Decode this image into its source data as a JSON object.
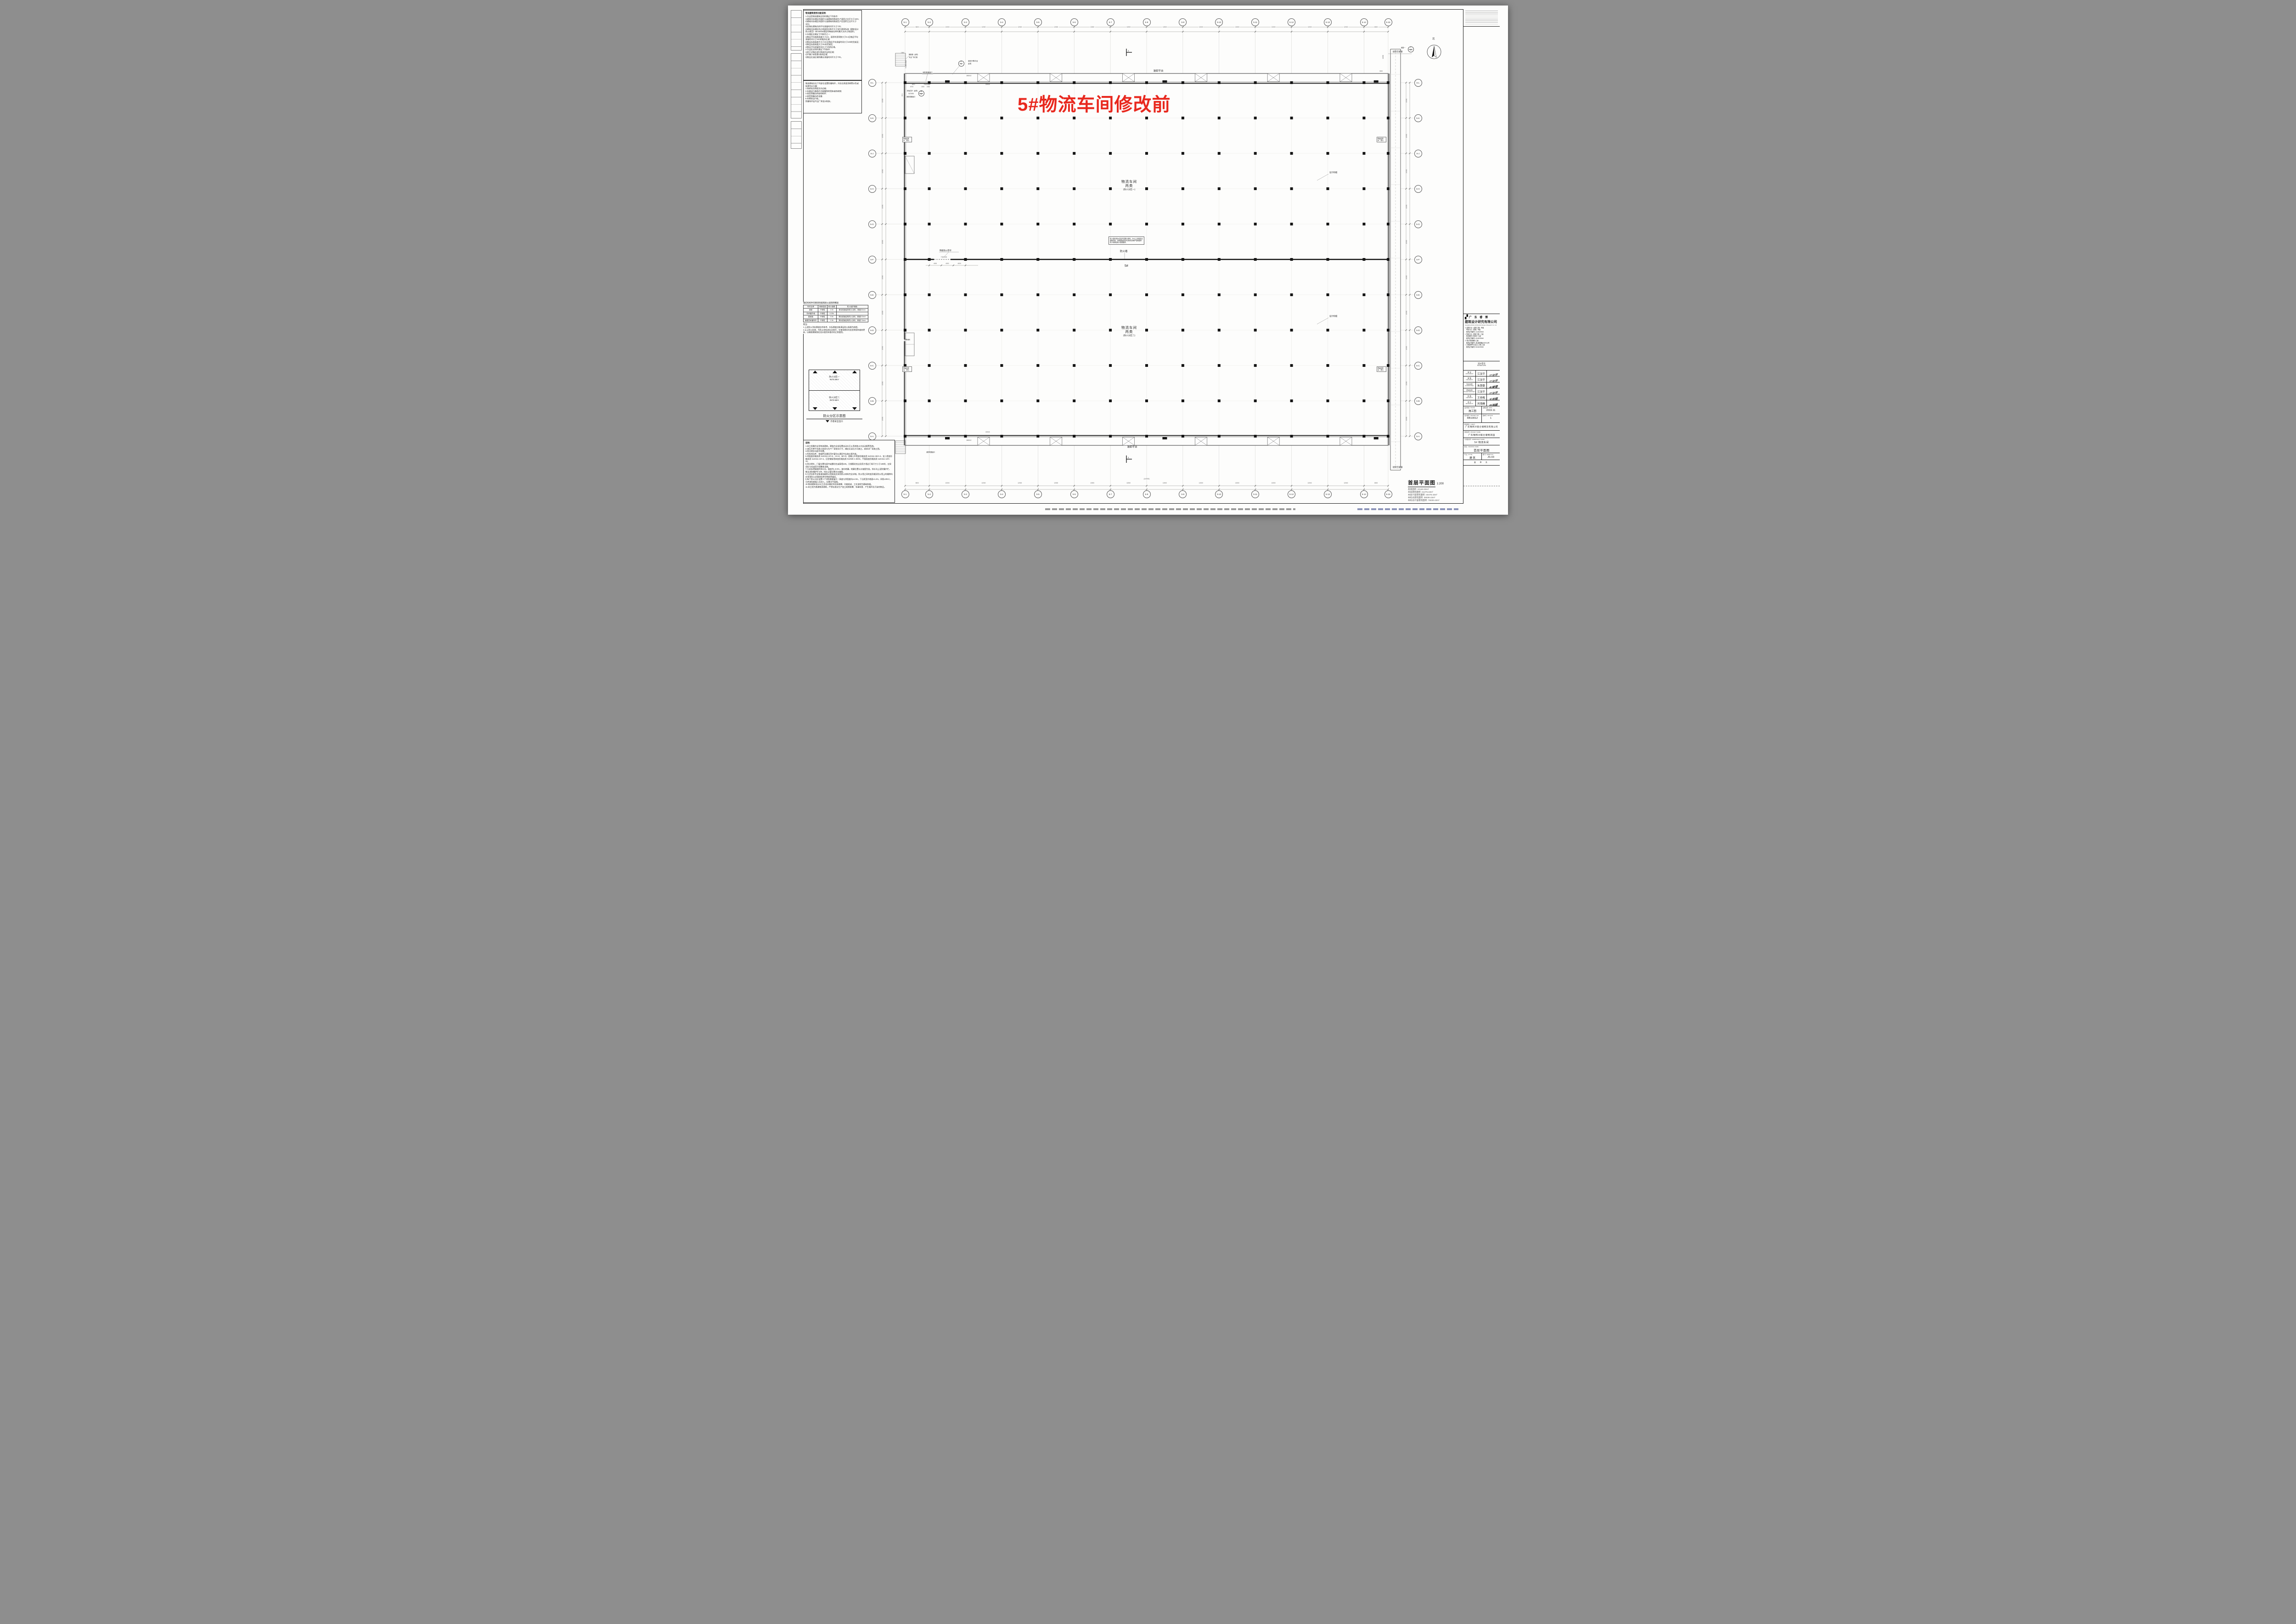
{
  "overlay": {
    "text": "5#物流车间修改前",
    "color": "#e8281e"
  },
  "notes_usage": {
    "title": "物流建筑使用功能说明:",
    "lines": [
      "1.作业型物流建筑应同时满足下列条件:",
      "1)建筑内存储区的面积与该建筑的物流生产面积之比不大于15%;",
      "2)建筑内存储区的容积与该建筑的物流生产区容积之比不大于15%;",
      "3)货物在建筑内的平均滞留时间不大于72h;",
      "4)建筑内存储区的占地面积总和不大于现行国家标准《建筑设计防火规范》GB 50016规定的每座仓库的最大允许占地面积。",
      "2.存储区应满足下列条件之一:",
      "1)物品平均堆放高度大于1m、面积利用系数大于0.4且物品平均滞留时间大于24h的堆存区域;",
      "2)物品存放高度不大于2m且物品平均滞留时间大于24h的货架区;",
      "3)物品存放高度大于2m的货架区;",
      "4)物品平均滞留时间大于72h的区域。",
      "3.作业区应同时满足下列条件:",
      "1)用于对物品进行物流作业的区域;",
      "2)不属于本条第1款的区域;",
      "3)物品在该区域的最长滞留时间不大于72h。"
    ]
  },
  "notes_collision": {
    "lines": [
      "物流建筑应在下列部位设置防撞构件，并应在表面涂刷警示色或贴黄色反光膜:",
      "1.装卸站台侧面及外边缘;",
      "2.车辆运行路线内可碰撞到的墙体或构筑物;",
      "3.易受到撞击的结构构件;",
      "4.易受到撞击的设备;",
      "5.车辆进出口处。",
      "防撞构件由专业厂商设计制安。"
    ]
  },
  "fire_table": {
    "title": "钢结构构件的燃烧性能和耐火极限明细表",
    "headers": [
      "构件名称",
      "燃烧性能",
      "耐火极限",
      "防火保护措施"
    ],
    "rows": [
      [
        "钢梁",
        "不燃性",
        "2.0h",
        "厚涂型钢结构防火涂料，厚度30mm"
      ],
      [
        "非承重外墙",
        "不燃性",
        "0.25h",
        ""
      ],
      [
        "屋面板",
        "不燃性",
        "0.5h",
        "薄涂型钢结构防火涂料，厚度3.0mm"
      ],
      [
        "钢屋顶承重构件",
        "不燃性",
        "1.5h",
        "薄涂型钢结构防火涂料，厚度7.0mm"
      ]
    ],
    "notes_title": "附注:",
    "notes": [
      "1.上述防火涂料厚度仅供参考，实际厚度应能满足耐火极限为前提。",
      "2.以上防火处理，为防止材料老化及损坏，在使用期间内应经常保持维修更新，以确保建筑物在设计使用年限内的正常使用。"
    ]
  },
  "fire_zone_diagram": {
    "title": "防火分区示意图",
    "legend": "示意安全出口",
    "zones": [
      {
        "name": "防火分区一",
        "area": "9575.58m²"
      },
      {
        "name": "防火分区二",
        "area": "9575.58m²"
      }
    ]
  },
  "general_notes": {
    "title": "说明:",
    "lines": [
      "1.本工程属作业型物流建筑。建筑内全部设置自动水灭火系统和火灾自动报警系统。",
      "2.液压升降平台施工前须与生产厂家核实尺寸，确定无误后方可施工，具体详厂家施工图。",
      "3.除注明外均居中布置。",
      "4.所有排风井、排烟井及通风百叶窗均以通风专业施工图为准。",
      "5.地面变形缝选用 11ZJ111 2/A-8、A/A-8、B/A-8，混凝土外墙变形缝选用 11ZJ111 26/A-2，女儿墙变形缝选用 11ZJ111 4/A-4，压型钢板墙体变形缝选用 01J925-1 48/44，平屋面变形缝选用 11ZJ111 12/A-12。",
      "6.除注明外，门窗位置均居中或靠砼柱或离墙100。凡钢筋砼柱边及剪力墙边门垛尺寸小于100时，应采用砼与柱或剪力墙整体浇筑。",
      "7.凡未标明坡度的排水沟，坡度为i=0.5%，坡向地漏，地漏位置以水施图为准。排水沟上设防撞护栏，做法详防撞护栏 8/9，排水立管位置详水施图。",
      "8.凡涉及各专业管道穿越防火墙体处应采用防火材料完全封堵。防火墙之间的变形缝及防火墙上的缝隙均应采用防火封堵材料将空隙紧密填实。",
      "9.每个防火分区设置二个消防救援窗口（高度与净宽度均≥1.0m，下沿距室内地面≤1.2m，间距≤20m），可供消防救援人员进入，位置详平面图。",
      "10.物流建筑设计以工艺设计确定的总体规模、功能组成、工艺流程为基础依据。",
      "11.本工程为普通物流建筑，严禁存放及生产加工易燃易爆、有毒有害、产生噪声及污染的物品。"
    ]
  },
  "plan": {
    "grid_top": {
      "labels": [
        "5-1",
        "5-2",
        "5-3",
        "5-4",
        "5-5",
        "5-6",
        "5-7",
        "5-8",
        "5-9",
        "5-10",
        "5-11",
        "5-12",
        "5-13",
        "5-14",
        "5-15"
      ],
      "dims": [
        "8000",
        "12000",
        "12000",
        "12000",
        "12000",
        "12000",
        "12000",
        "12000",
        "12000",
        "12000",
        "12000",
        "12000",
        "12000",
        "8000"
      ],
      "overall": "(144000)"
    },
    "grid_left": {
      "labels": [
        "5-L",
        "5-K",
        "5-J",
        "5-H",
        "5-G",
        "5-F",
        "5-E",
        "5-D",
        "5-C",
        "5-B",
        "5-A"
      ],
      "dims": [
        "12000",
        "12000",
        "12000",
        "12000",
        "12000",
        "12000",
        "12000",
        "12000",
        "12000",
        "12000"
      ]
    },
    "labels": {
      "zone1": [
        "物流车间",
        "丙类",
        "(防火分区一)"
      ],
      "zone2": [
        "物流车间",
        "丙类",
        "(防火分区二)"
      ],
      "firewall": "防火墙",
      "firewall_shutter": "特级防火卷帘",
      "firewall_door": "FJM4030",
      "firewall_note": "防火墙采用3m高加气混凝土砌块，3m以上采用复合墙板拼接。拼接缝隙采用水泥砂浆封堵严密使整体防火墙满足耐火极限要求。",
      "building_no": "5#",
      "dock_top": "装卸平台",
      "dock_bottom": "装卸平台",
      "corridor_top": "接架空通廊",
      "corridor_bottom": "接架空通廊",
      "design_joint": "设计构缝",
      "reserve_drain": "预留给排水、排污",
      "alarm_room": "报警阀间",
      "steel_ladder": "钢制梯（余同）",
      "steel_ladder2": "专业厂商订制",
      "lift_platform": "液压升降平台",
      "lift_again": "余同",
      "rescue_window": "消防救援窗口",
      "window_rail": "护窗栏杆（余同）",
      "window_rail_ref": "11ZJ401",
      "ramp_name": "坡道一",
      "north": "北",
      "section_no": "1",
      "zc1": "ZC1",
      "door_mc1": "MC1",
      "door_fmz": "FMZ1521",
      "win_c8018": "C8018",
      "dock_jm": "JM8042",
      "dims_mid": [
        "4000",
        "4000",
        "4000"
      ],
      "bubble_69": [
        "6",
        "9"
      ],
      "bubble_110": [
        "1",
        "10"
      ],
      "bubble_2b34": [
        "2B",
        "34"
      ],
      "dim_11500": "11500",
      "dim_3000": "3000",
      "dim_1500": "1500",
      "dim_stair": "7X260=1820",
      "dim_6700": "6700",
      "dim_1300": "1300",
      "dim_1500b": "1500"
    }
  },
  "stats": {
    "plan_title": "首层平面图",
    "plan_scale": "1:200",
    "items": [
      "基底面积: 20160.00m²",
      "本层建筑面积: 21279.43m²",
      "本层计容建筑面积: 40479.43m²",
      "本栋总建筑面积: 39039.43m²",
      "本栋总计容建筑面积: 75039.43m²"
    ]
  },
  "title_block": {
    "company_cn": "广 东 睿 博",
    "company_cn2": "建筑设计研究有限公司",
    "company_en": "Guangdong Ruibo Architectural Design & Research Co., Ltd",
    "quals": [
      {
        "checked": true,
        "text": "建筑行业（建筑工程）甲级"
      },
      {
        "checked": null,
        "text": "市政行业（道路）甲级"
      },
      {
        "checked": null,
        "text": "资质证书编号: A144028943"
      },
      {
        "checked": false,
        "text": "市政行业（桥梁工程）乙级"
      },
      {
        "checked": null,
        "text": "风景园林工程设计 乙级"
      },
      {
        "checked": null,
        "text": "资质证书编号: A244028940"
      },
      {
        "checked": true,
        "text": "城乡规划编制 乙级"
      },
      {
        "checked": null,
        "text": "资质证书编号: (粤)城规编(182011)号"
      },
      {
        "checked": false,
        "text": "工程勘察专业(岩土工程) 乙级"
      },
      {
        "checked": null,
        "text": "资质证书编号: B244028940"
      }
    ],
    "signature_label": "设计签字",
    "signature_label_en": "SIGNATURE",
    "rows": [
      {
        "cn": "审 定",
        "en": "APPROVED BY",
        "name": "江汝平"
      },
      {
        "cn": "审 核",
        "en": "CHECKED BY",
        "name": "江汝平"
      },
      {
        "cn": "专业负责",
        "en": "DIVISION CHIEF",
        "name": "朱慧雯"
      },
      {
        "cn": "项目负责",
        "en": "PROJECT ARCHITECT",
        "name": "江汝平"
      },
      {
        "cn": "校 核",
        "en": "CHECKED BY",
        "name": "王杏梅"
      },
      {
        "cn": "设 计",
        "en": "DESIGNED BY",
        "name": "刘海峰"
      }
    ],
    "phase_label": "设计阶段",
    "phase_en": "PHASE",
    "phase": "施工图",
    "date_label": "出图日期",
    "date_en": "DATE",
    "date": "2019.11",
    "projno_label": "设计编号",
    "projno_en": "PROJECT NO.",
    "projno": "RB19012",
    "edition_label": "版本号",
    "edition_en": "EDITION",
    "edition": "1",
    "client_label": "建设单位",
    "client_en": "CLIENT",
    "client": "广东锦邦冷链仓储物流有限公司",
    "project_label": "项目名称",
    "project_en": "PROJECT NAME",
    "project": "广东锦邦冷链仓储物流园",
    "subproject_label": "子项目名称",
    "subproject_en": "SUBPROJECT NAME",
    "subproject": "5# 物流车间",
    "drawing_label": "图 名",
    "drawing_en": "DRAWING NAME",
    "drawing": "首层平面图",
    "style_label": "专 业",
    "style_en": "STYLE",
    "style": "建 筑",
    "sheet_label": "图 号",
    "sheet_en": "SHEET NO.",
    "sheet_no": "JS-03",
    "stamp": "盖 章 处"
  }
}
